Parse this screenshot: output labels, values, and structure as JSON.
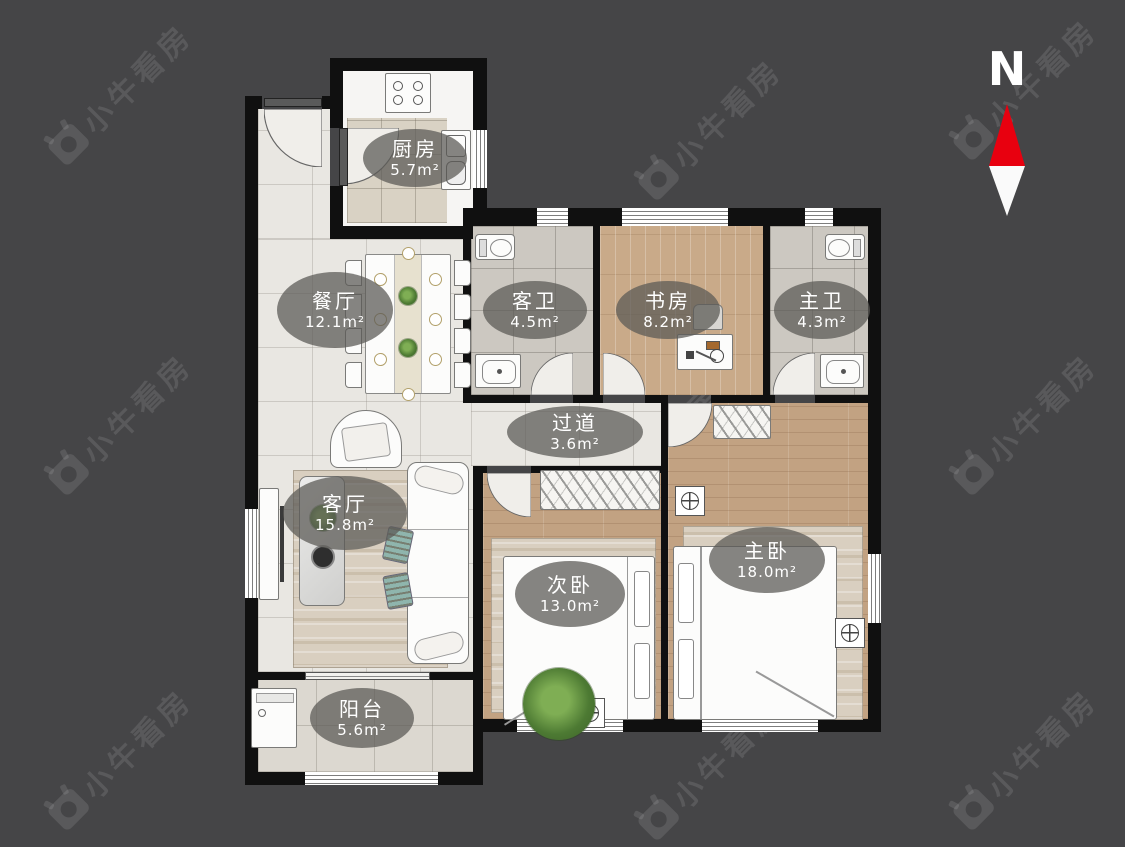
{
  "watermark": {
    "text": "小牛看房"
  },
  "compass": {
    "label": "N"
  },
  "rooms": [
    {
      "id": "kitchen",
      "name": "厨房",
      "area": "5.7m²"
    },
    {
      "id": "dining",
      "name": "餐厅",
      "area": "12.1m²"
    },
    {
      "id": "guest-bath",
      "name": "客卫",
      "area": "4.5m²"
    },
    {
      "id": "study",
      "name": "书房",
      "area": "8.2m²"
    },
    {
      "id": "master-bath",
      "name": "主卫",
      "area": "4.3m²"
    },
    {
      "id": "hallway",
      "name": "过道",
      "area": "3.6m²"
    },
    {
      "id": "living",
      "name": "客厅",
      "area": "15.8m²"
    },
    {
      "id": "second-bedroom",
      "name": "次卧",
      "area": "13.0m²"
    },
    {
      "id": "master-bedroom",
      "name": "主卧",
      "area": "18.0m²"
    },
    {
      "id": "balcony",
      "name": "阳台",
      "area": "5.6m²"
    }
  ],
  "colors": {
    "background": "#454547",
    "wall": "#101010",
    "compass_red": "#e8000f"
  }
}
